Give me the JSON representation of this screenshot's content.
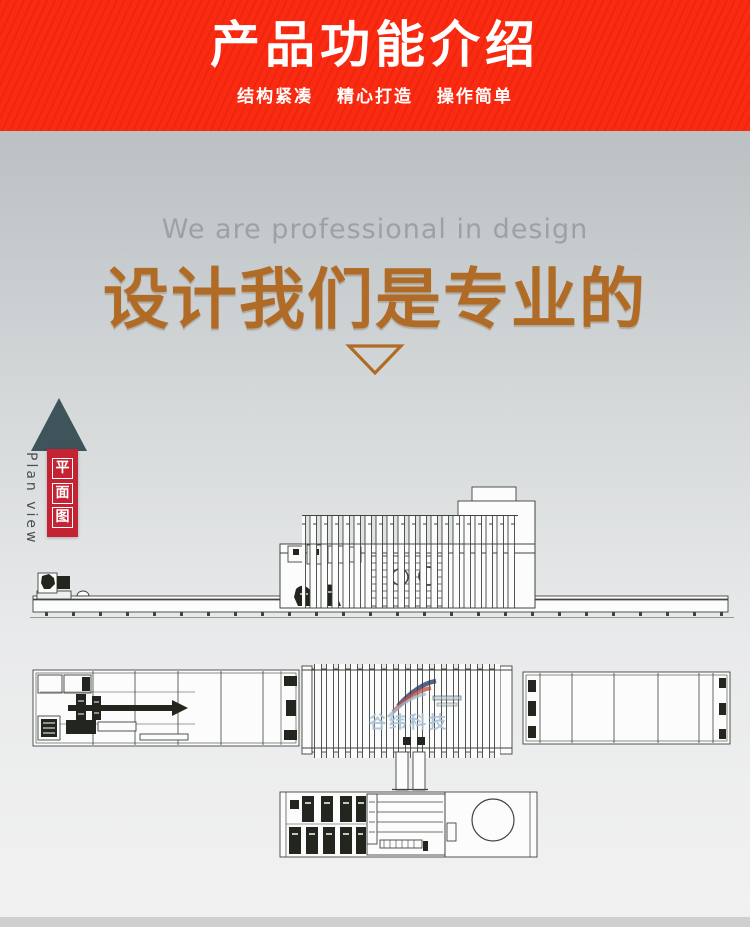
{
  "header": {
    "title": "产品功能介绍",
    "subtitle": "结构紧凑 精心打造 操作简单",
    "bg_color": "#fb2a11",
    "text_color": "#ffffff"
  },
  "intro": {
    "caption_en": "We are professional in design",
    "title_cn": "设计我们是专业的",
    "accent_color": "#b06c26",
    "caption_color": "#9ba1a4"
  },
  "side_label": {
    "cn_chars": [
      "平",
      "面",
      "图"
    ],
    "en": "Plan view",
    "box_color": "#c32332",
    "arrow_color": "#3e545a"
  },
  "watermark": {
    "text": "谷纬科技",
    "color": "#a9c2d6"
  },
  "drawing": {
    "stroke_color": "#3f443e"
  }
}
